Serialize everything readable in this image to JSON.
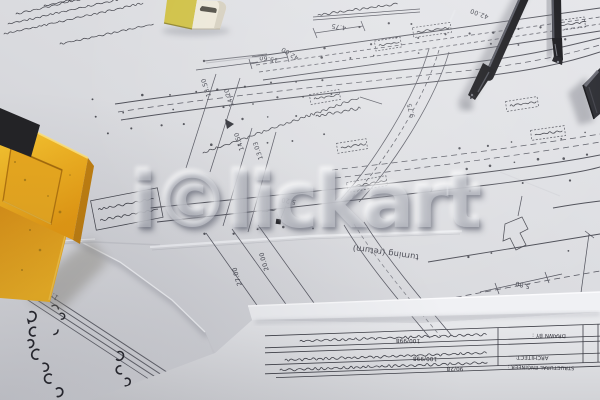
{
  "watermark": {
    "text": "i©lickart",
    "color": "#e2e4e9"
  },
  "drawing": {
    "dims": {
      "a": "4.75",
      "b": "42.00",
      "c": "15.60",
      "d": "13.50",
      "e": "14.20",
      "f": "14.50",
      "g": "13.03",
      "h": "9.75",
      "i": "5.20",
      "j": "27.00",
      "k": "20.00",
      "l": "5.80"
    },
    "labels": {
      "turning": "turning (return)"
    }
  },
  "scale_note": {
    "label": "SCALE",
    "value": "1:200"
  },
  "markers": {
    "hex1": "1",
    "hex2": "2"
  },
  "title_block": {
    "rows": [
      {
        "label": "DRAWN BY :",
        "fragment": "100/998"
      },
      {
        "label": "ARCHITECT:",
        "fragment": "100/998"
      },
      {
        "label": "STRUCTURAL ENGINEER :",
        "fragment": "90/28"
      }
    ]
  },
  "colors": {
    "paper": "#d9dade",
    "ink": "#4b4c55",
    "tool_yellow": "#f0b222",
    "steel": "#141418"
  }
}
